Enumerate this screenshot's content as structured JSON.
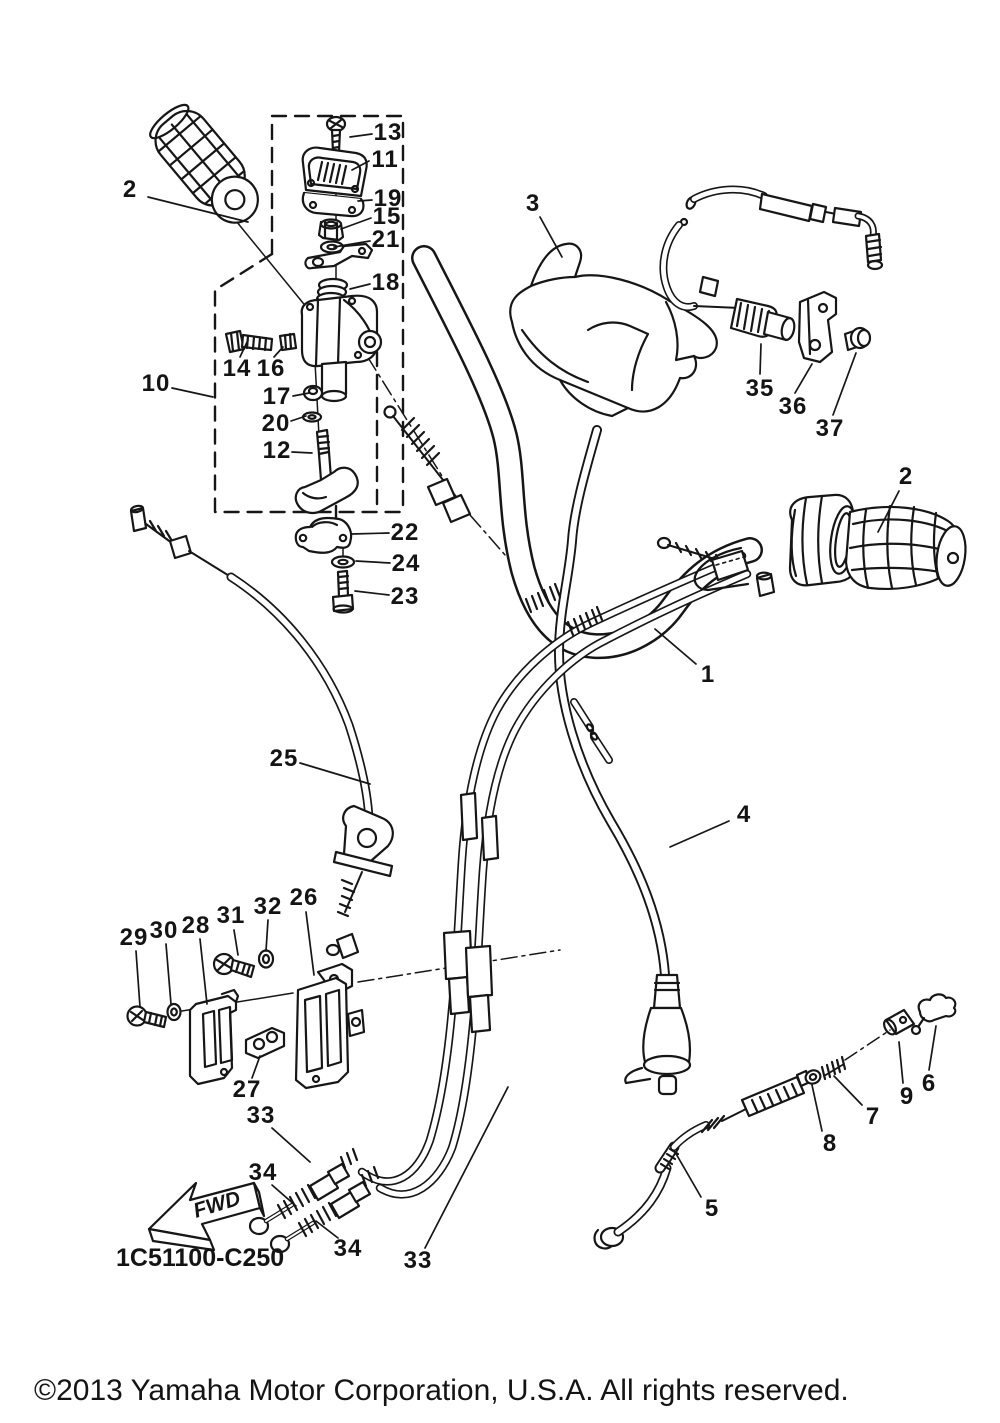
{
  "labels": {
    "fwd": "FWD",
    "part_code": "1C51100-C250",
    "copyright": "©2013 Yamaha Motor Corporation, U.S.A. All rights reserved."
  },
  "callouts": [
    {
      "n": "13",
      "x": 388,
      "y": 133
    },
    {
      "n": "11",
      "x": 385,
      "y": 160
    },
    {
      "n": "19",
      "x": 388,
      "y": 199
    },
    {
      "n": "15",
      "x": 387,
      "y": 217
    },
    {
      "n": "21",
      "x": 386,
      "y": 240
    },
    {
      "n": "18",
      "x": 386,
      "y": 283
    },
    {
      "n": "2",
      "x": 130,
      "y": 190
    },
    {
      "n": "10",
      "x": 156,
      "y": 384
    },
    {
      "n": "14",
      "x": 237,
      "y": 369
    },
    {
      "n": "16",
      "x": 271,
      "y": 369
    },
    {
      "n": "17",
      "x": 277,
      "y": 397
    },
    {
      "n": "20",
      "x": 276,
      "y": 424
    },
    {
      "n": "12",
      "x": 277,
      "y": 451
    },
    {
      "n": "22",
      "x": 405,
      "y": 533
    },
    {
      "n": "24",
      "x": 406,
      "y": 564
    },
    {
      "n": "23",
      "x": 405,
      "y": 597
    },
    {
      "n": "3",
      "x": 533,
      "y": 204
    },
    {
      "n": "35",
      "x": 760,
      "y": 389
    },
    {
      "n": "36",
      "x": 793,
      "y": 407
    },
    {
      "n": "37",
      "x": 830,
      "y": 429
    },
    {
      "n": "2",
      "x": 906,
      "y": 477
    },
    {
      "n": "1",
      "x": 708,
      "y": 675
    },
    {
      "n": "25",
      "x": 284,
      "y": 759
    },
    {
      "n": "4",
      "x": 744,
      "y": 815
    },
    {
      "n": "29",
      "x": 134,
      "y": 938
    },
    {
      "n": "30",
      "x": 164,
      "y": 931
    },
    {
      "n": "28",
      "x": 196,
      "y": 926
    },
    {
      "n": "31",
      "x": 231,
      "y": 916
    },
    {
      "n": "32",
      "x": 268,
      "y": 907
    },
    {
      "n": "26",
      "x": 304,
      "y": 898
    },
    {
      "n": "27",
      "x": 247,
      "y": 1090
    },
    {
      "n": "33",
      "x": 261,
      "y": 1116
    },
    {
      "n": "34",
      "x": 263,
      "y": 1173
    },
    {
      "n": "34",
      "x": 348,
      "y": 1249
    },
    {
      "n": "33",
      "x": 418,
      "y": 1261
    },
    {
      "n": "5",
      "x": 712,
      "y": 1209
    },
    {
      "n": "8",
      "x": 830,
      "y": 1144
    },
    {
      "n": "7",
      "x": 873,
      "y": 1117
    },
    {
      "n": "9",
      "x": 907,
      "y": 1097
    },
    {
      "n": "6",
      "x": 929,
      "y": 1084
    }
  ]
}
